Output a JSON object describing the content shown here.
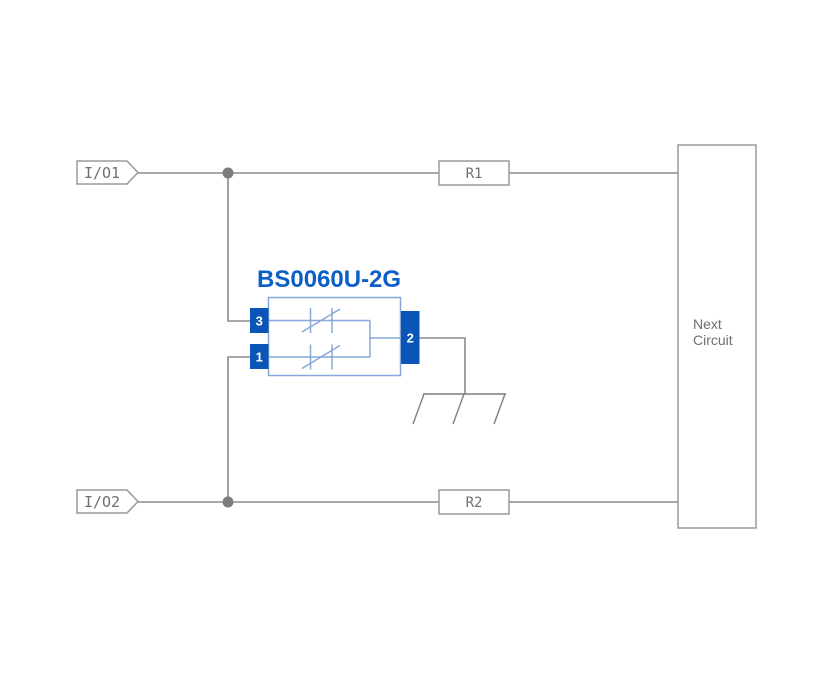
{
  "diagram": {
    "kind": "esd-protection-application-circuit",
    "io_labels": {
      "io1": "I/O1",
      "io2": "I/O2"
    },
    "resistors": {
      "r1": "R1",
      "r2": "R2"
    },
    "next_circuit": {
      "line1": "Next",
      "line2": "Circuit"
    },
    "component": {
      "name": "BS0060U-2G",
      "pin_left_top": "3",
      "pin_left_bottom": "1",
      "pin_right": "2"
    },
    "icons": {
      "ground": "chassis-ground-icon",
      "junction": "junction-dot"
    },
    "colors": {
      "background": "#ffffff",
      "wire_gray": "#8c8c8c",
      "text_gray": "#6f6f6f",
      "box_stroke": "#9a9a9a",
      "component_blue": "#0b55b8",
      "title_blue": "#0d5fc8",
      "component_light_blue": "#86a8d8",
      "junction_gray": "#7d7d7d"
    }
  }
}
